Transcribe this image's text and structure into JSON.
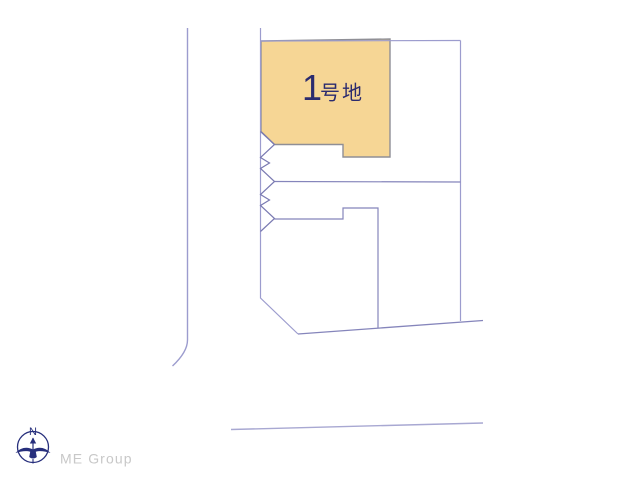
{
  "page": {
    "background": "#ffffff"
  },
  "plot1": {
    "number": "1",
    "suffix": "号地",
    "fill_color": "#f6d695",
    "border_color": "#8f8f96",
    "label_color": "#2b2b6e"
  },
  "diagram": {
    "boundary_color": "#9c9cce",
    "inner_line_color": "#8585bb",
    "mark_color": "#7a7ab2",
    "road_line_color": "#a8a8d2"
  },
  "footer": {
    "compass_label": "N",
    "brand": "ME Group",
    "compass_color": "#272f7c",
    "brand_color": "#c8c8c8"
  }
}
